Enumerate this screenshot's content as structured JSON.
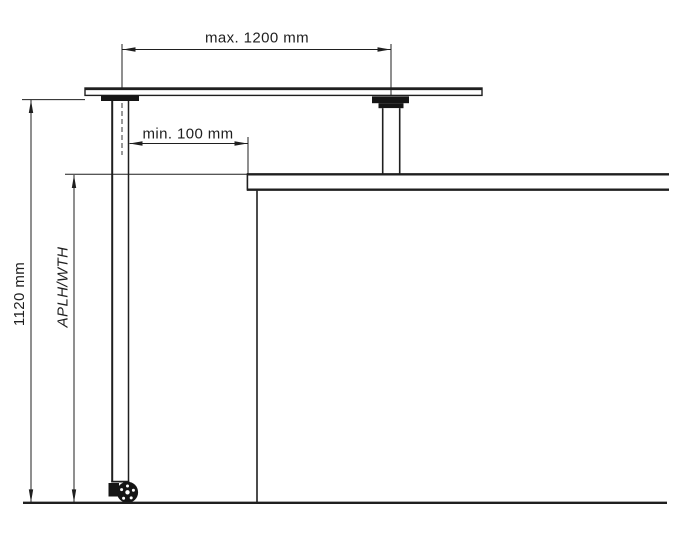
{
  "colors": {
    "line": "#1f1f1f",
    "ink": "#151515",
    "background": "#ffffff"
  },
  "labels": {
    "max_width": "max. 1200 mm",
    "min_clearance": "min. 100 mm",
    "overall_height": "1120 mm",
    "worktop_height": "APLH/WTH"
  }
}
